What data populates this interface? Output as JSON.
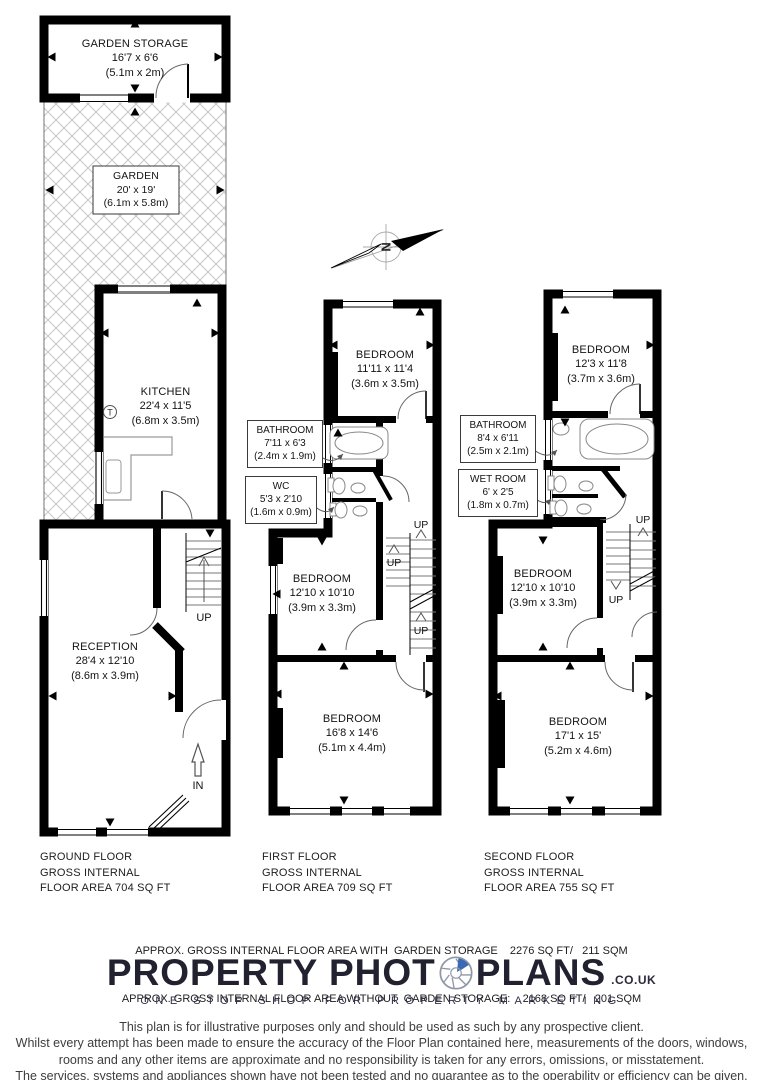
{
  "plan_labels": {
    "up": "UP",
    "in": "IN",
    "boiler": "T"
  },
  "compass": {
    "north_label": "N"
  },
  "ground_floor": {
    "rooms": [
      {
        "name": "GARDEN STORAGE",
        "size_ft": "16'7 x 6'6",
        "size_m": "(5.1m x 2m)"
      },
      {
        "name": "GARDEN",
        "size_ft": "20' x 19'",
        "size_m": "(6.1m x 5.8m)"
      },
      {
        "name": "KITCHEN",
        "size_ft": "22'4 x 11'5",
        "size_m": "(6.8m x 3.5m)"
      },
      {
        "name": "RECEPTION",
        "size_ft": "28'4 x 12'10",
        "size_m": "(8.6m x 3.9m)"
      }
    ],
    "caption": {
      "line1": "GROUND FLOOR",
      "line2": "GROSS INTERNAL",
      "line3": "FLOOR AREA 704 SQ FT"
    }
  },
  "first_floor": {
    "rooms": [
      {
        "name": "BEDROOM",
        "size_ft": "11'11 x 11'4",
        "size_m": "(3.6m x 3.5m)"
      },
      {
        "name": "BATHROOM",
        "size_ft": "7'11 x 6'3",
        "size_m": "(2.4m x 1.9m)"
      },
      {
        "name": "WC",
        "size_ft": "5'3 x 2'10",
        "size_m": "(1.6m x 0.9m)"
      },
      {
        "name": "BEDROOM",
        "size_ft": "12'10 x 10'10",
        "size_m": "(3.9m x 3.3m)"
      },
      {
        "name": "BEDROOM",
        "size_ft": "16'8 x 14'6",
        "size_m": "(5.1m x 4.4m)"
      }
    ],
    "caption": {
      "line1": "FIRST FLOOR",
      "line2": "GROSS INTERNAL",
      "line3": "FLOOR AREA 709 SQ FT"
    }
  },
  "second_floor": {
    "rooms": [
      {
        "name": "BEDROOM",
        "size_ft": "12'3 x 11'8",
        "size_m": "(3.7m x 3.6m)"
      },
      {
        "name": "BATHROOM",
        "size_ft": "8'4 x 6'11",
        "size_m": "(2.5m x 2.1m)"
      },
      {
        "name": "WET ROOM",
        "size_ft": "6' x 2'5",
        "size_m": "(1.8m x 0.7m)"
      },
      {
        "name": "BEDROOM",
        "size_ft": "12'10 x 10'10",
        "size_m": "(3.9m x 3.3m)"
      },
      {
        "name": "BEDROOM",
        "size_ft": "17'1 x 15'",
        "size_m": "(5.2m x 4.6m)"
      }
    ],
    "caption": {
      "line1": "SECOND FLOOR",
      "line2": "GROSS INTERNAL",
      "line3": "FLOOR AREA 755 SQ FT"
    }
  },
  "summary": {
    "line1": "APPROX. GROSS INTERNAL FLOOR AREA WITH  GARDEN STORAGE    2276 SQ FT/   211 SQM",
    "line2": "APPROX. GROSS INTERNAL FLOOR AREA WITHOUT  GARDEN STORAGE:    2168 SQ FT/   201 SQM"
  },
  "logo": {
    "brand_left": "PROPERTY PHOT",
    "brand_right": "PLANS",
    "domain": ".CO.UK",
    "tagline": "ONE STOP SHOP FOR PROPERTY MARKETING",
    "accent": "#3a6ab5"
  },
  "disclaimer": {
    "line1": "This plan is for illustrative purposes only and should be used as such by any prospective client.",
    "line2": "Whilst every attempt has been made to ensure the accuracy of the Floor Plan contained here, measurements of the doors, windows,",
    "line3": "rooms and any other items are approximate and no responsibility is taken for any errors, omissions, or misstatement.",
    "line4": "The services, systems and appliances shown have not been tested and no guarantee as to the operability or efficiency can be given."
  }
}
